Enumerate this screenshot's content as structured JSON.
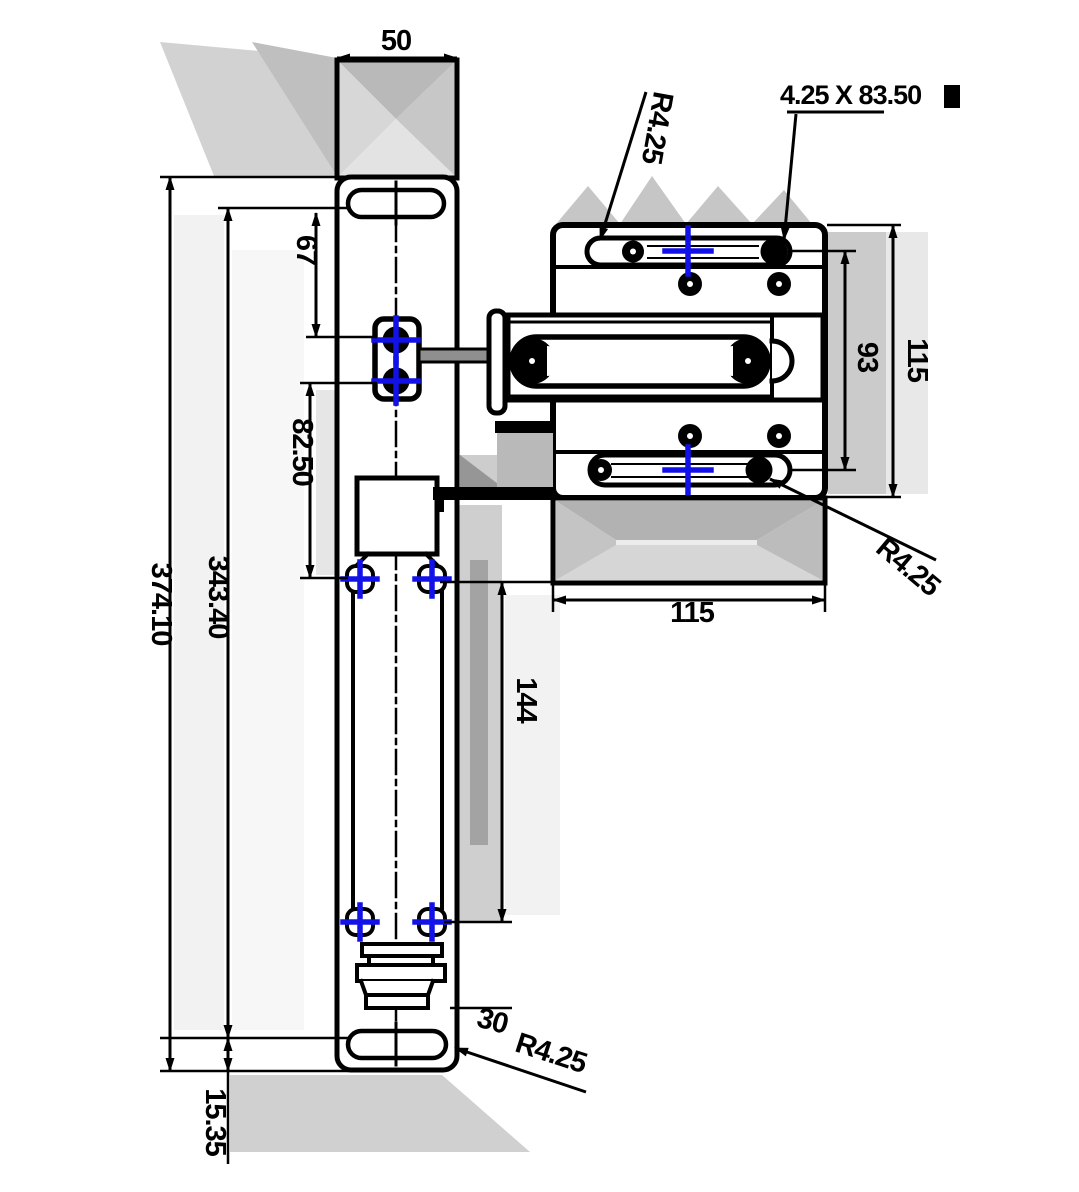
{
  "drawing_type": "2-view mechanical CAD dimension drawing",
  "colors": {
    "line": "#000000",
    "center_mark_blue": "#1212e8",
    "part_fill": "#ffffff",
    "shading_gray": "#c9c9c9"
  },
  "front_view": {
    "dims": {
      "width_top": "50",
      "slot_to_hole": "67",
      "hole_spacing": "82.50",
      "overall_height": "374.10",
      "body_height": "343.40",
      "bottom_offset": "15.35",
      "channel_length": "144",
      "plug_offset": "30",
      "slot_radius": "R4.25"
    }
  },
  "side_view": {
    "dims": {
      "slot_radius_top": "R4.25",
      "slot_spec": "4.25 X 83.50",
      "overall_height_right": "115",
      "slot_center_spacing": "93",
      "overall_width_bottom": "115",
      "slot_radius_bottom": "R4.25"
    }
  }
}
